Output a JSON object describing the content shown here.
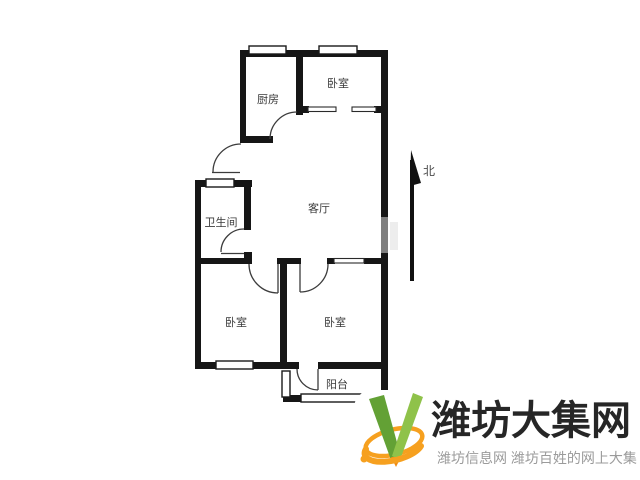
{
  "floorplan": {
    "rooms": {
      "kitchen": "厨房",
      "bedroom_top": "卧室",
      "living_room": "客厅",
      "bathroom": "卫生间",
      "bedroom_left": "卧室",
      "bedroom_right": "卧室",
      "balcony": "阳台"
    },
    "compass": {
      "north_label": "北"
    },
    "wall_color": "#161616",
    "door_line_color": "#444444",
    "label_color": "#3a3a3a"
  },
  "branding": {
    "site_name": "潍坊大集网",
    "tagline": "潍坊信息网 潍坊百姓的网上大集",
    "logo_icon": "green-check-v-with-orange-swoosh",
    "colors": {
      "green_dark": "#63a135",
      "green_light": "#8fc24a",
      "orange": "#f6a01f",
      "name_text": "#262626",
      "tagline_text": "#9b9b9b"
    }
  }
}
